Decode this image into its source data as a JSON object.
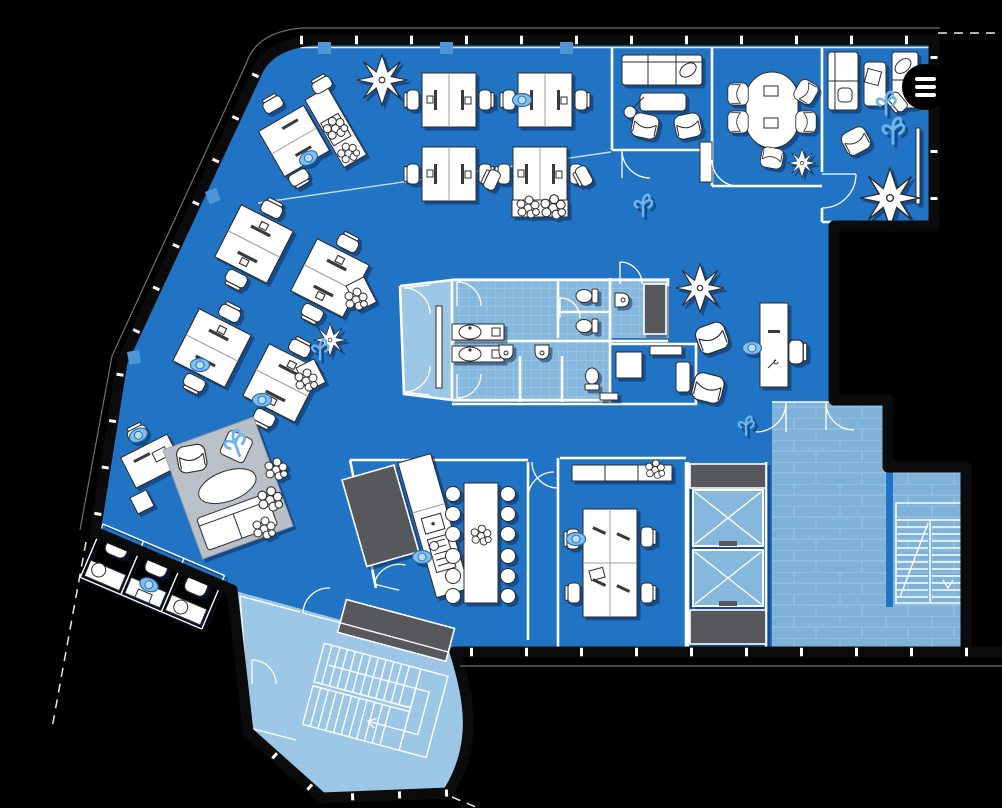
{
  "window": {
    "background": "#000000"
  },
  "menu_button": {
    "icon": "hamburger-menu-icon",
    "aria_label": "Menu",
    "background": "#000000",
    "bar_color": "#ffffff",
    "bar_count": 3
  },
  "floor_plan": {
    "type": "office-floor-plan-blueprint",
    "colors": {
      "floor": "#2173c4",
      "tile": "#86b8dd",
      "tile_line": "#a6cbe9",
      "tile_light": "#9cc6e6",
      "terrace_tile": "#7fb2d9",
      "terrace_line": "#98c2e3",
      "wall": "#0b0b0b",
      "inner_wall": "#ffffff",
      "furniture": "#ffffff",
      "furniture_outline": "#2b2b2b",
      "dark_fixture": "#57585c",
      "rug": "#b9c0c7",
      "accent": "#6fb5ec",
      "column": "#4e96d6",
      "shadow": "rgba(10,35,80,0.5)"
    }
  }
}
